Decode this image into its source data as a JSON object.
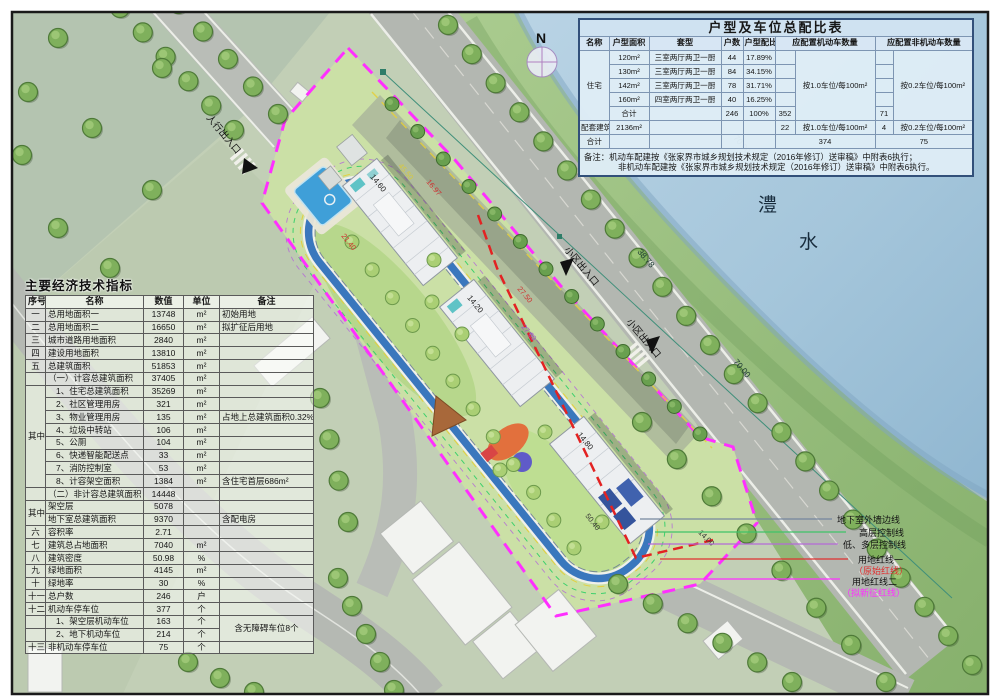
{
  "doc": {
    "north": "N",
    "river": [
      "澧",
      "水"
    ]
  },
  "labels": {
    "pedestrian_entrance": "人行出入口",
    "community_entrance": "小区出入口"
  },
  "dims": {
    "d70a": "70.00",
    "d70b": "70.00",
    "d3878": "38.78",
    "d4550": "45.50",
    "d1697": "16.97",
    "d2140": "21.40",
    "d2750": "27.50",
    "d2769": "27.69",
    "d5040": "50.40",
    "d1400": "14.00"
  },
  "elevations": [
    "14.60",
    "14.20",
    "14.80"
  ],
  "legend": {
    "items": [
      {
        "label": "地下室外墙边线",
        "color": "#76869e"
      },
      {
        "label": "高层控制线",
        "color": "#3fc468"
      },
      {
        "label": "低、多层控制线",
        "color": "#b46ad8"
      },
      {
        "label": "用地红线一",
        "sub": "（原始红线）",
        "color": "#e03030"
      },
      {
        "label": "用地红线二",
        "sub": "（拟新征红线）",
        "color": "#ff2fff"
      }
    ]
  },
  "economic_table": {
    "title": "主要经济技术指标",
    "header": [
      {
        "t": "序号",
        "cls": "h"
      },
      {
        "t": "名称",
        "cls": "h"
      },
      {
        "t": "数值",
        "cls": "h"
      },
      {
        "t": "单位",
        "cls": "h"
      },
      {
        "t": "备注",
        "cls": "h"
      }
    ],
    "rows": [
      [
        {
          "t": "一"
        },
        {
          "t": "总用地面积一",
          "cls": "L"
        },
        {
          "t": "13748"
        },
        {
          "t": "m²"
        },
        {
          "t": "初始用地",
          "cls": "L"
        }
      ],
      [
        {
          "t": "二"
        },
        {
          "t": "总用地面积二",
          "cls": "L"
        },
        {
          "t": "16650"
        },
        {
          "t": "m²"
        },
        {
          "t": "拟扩征后用地",
          "cls": "L"
        }
      ],
      [
        {
          "t": "三"
        },
        {
          "t": "城市道路用地面积",
          "cls": "L"
        },
        {
          "t": "2840"
        },
        {
          "t": "m²"
        },
        {
          "t": ""
        }
      ],
      [
        {
          "t": "四"
        },
        {
          "t": "建设用地面积",
          "cls": "L"
        },
        {
          "t": "13810"
        },
        {
          "t": "m²"
        },
        {
          "t": ""
        }
      ],
      [
        {
          "t": "五"
        },
        {
          "t": "总建筑面积",
          "cls": "L"
        },
        {
          "t": "51853"
        },
        {
          "t": "m²"
        },
        {
          "t": ""
        }
      ],
      [
        {
          "t": ""
        },
        {
          "t": "（一）计容总建筑面积",
          "cls": "L"
        },
        {
          "t": "37405"
        },
        {
          "t": "m²"
        },
        {
          "t": ""
        }
      ],
      [
        {
          "t": "其中",
          "rs": 8
        },
        {
          "t": "1、住宅总建筑面积",
          "cls": "L i"
        },
        {
          "t": "35269"
        },
        {
          "t": "m²"
        },
        {
          "t": ""
        }
      ],
      [
        {
          "t": "2、社区管理用房",
          "cls": "L i"
        },
        {
          "t": "321"
        },
        {
          "t": "m²"
        },
        {
          "t": ""
        }
      ],
      [
        {
          "t": "3、物业管理用房",
          "cls": "L i"
        },
        {
          "t": "135"
        },
        {
          "t": "m²"
        },
        {
          "t": "占地上总建筑面积0.32%",
          "cls": "L"
        }
      ],
      [
        {
          "t": "4、垃圾中转站",
          "cls": "L i"
        },
        {
          "t": "106"
        },
        {
          "t": "m²"
        },
        {
          "t": ""
        }
      ],
      [
        {
          "t": "5、公厕",
          "cls": "L i"
        },
        {
          "t": "104"
        },
        {
          "t": "m²"
        },
        {
          "t": ""
        }
      ],
      [
        {
          "t": "6、快递智能配送点",
          "cls": "L i"
        },
        {
          "t": "33"
        },
        {
          "t": "m²"
        },
        {
          "t": ""
        }
      ],
      [
        {
          "t": "7、消防控制室",
          "cls": "L i"
        },
        {
          "t": "53"
        },
        {
          "t": "m²"
        },
        {
          "t": ""
        }
      ],
      [
        {
          "t": "8、计容架空面积",
          "cls": "L i"
        },
        {
          "t": "1384"
        },
        {
          "t": "m²"
        },
        {
          "t": "含住宅首层686m²",
          "cls": "L"
        }
      ],
      [
        {
          "t": ""
        },
        {
          "t": "（二）非计容总建筑面积",
          "cls": "L"
        },
        {
          "t": "14448"
        },
        {
          "t": ""
        },
        {
          "t": ""
        }
      ],
      [
        {
          "t": "其中",
          "rs": 2
        },
        {
          "t": "架空层",
          "cls": "L"
        },
        {
          "t": "5078"
        },
        {
          "t": ""
        },
        {
          "t": ""
        }
      ],
      [
        {
          "t": "地下室总建筑面积",
          "cls": "L"
        },
        {
          "t": "9370"
        },
        {
          "t": ""
        },
        {
          "t": "含配电房",
          "cls": "L"
        }
      ],
      [
        {
          "t": "六"
        },
        {
          "t": "容积率",
          "cls": "L"
        },
        {
          "t": "2.71"
        },
        {
          "t": ""
        },
        {
          "t": ""
        }
      ],
      [
        {
          "t": "七"
        },
        {
          "t": "建筑总占地面积",
          "cls": "L"
        },
        {
          "t": "7040"
        },
        {
          "t": "m²"
        },
        {
          "t": ""
        }
      ],
      [
        {
          "t": "八"
        },
        {
          "t": "建筑密度",
          "cls": "L"
        },
        {
          "t": "50.98"
        },
        {
          "t": "%"
        },
        {
          "t": ""
        }
      ],
      [
        {
          "t": "九"
        },
        {
          "t": "绿地面积",
          "cls": "L"
        },
        {
          "t": "4145"
        },
        {
          "t": "m²"
        },
        {
          "t": ""
        }
      ],
      [
        {
          "t": "十"
        },
        {
          "t": "绿地率",
          "cls": "L"
        },
        {
          "t": "30"
        },
        {
          "t": "%"
        },
        {
          "t": ""
        }
      ],
      [
        {
          "t": "十一"
        },
        {
          "t": "总户数",
          "cls": "L"
        },
        {
          "t": "246"
        },
        {
          "t": "户"
        },
        {
          "t": ""
        }
      ],
      [
        {
          "t": "十二"
        },
        {
          "t": "机动车停车位",
          "cls": "L"
        },
        {
          "t": "377"
        },
        {
          "t": "个"
        },
        {
          "t": ""
        }
      ],
      [
        {
          "t": ""
        },
        {
          "t": "1、架空层机动车位",
          "cls": "L i"
        },
        {
          "t": "163"
        },
        {
          "t": "个"
        },
        {
          "t": "含无障碍车位8个",
          "rs": 2
        }
      ],
      [
        {
          "t": ""
        },
        {
          "t": "2、地下机动车位",
          "cls": "L i"
        },
        {
          "t": "214"
        },
        {
          "t": "个"
        }
      ],
      [
        {
          "t": "十三"
        },
        {
          "t": "非机动车停车位",
          "cls": "L"
        },
        {
          "t": "75"
        },
        {
          "t": "个"
        },
        {
          "t": ""
        }
      ]
    ]
  },
  "parking_table": {
    "title": "户型及车位总配比表",
    "header": [
      {
        "t": "名称",
        "cls": "h"
      },
      {
        "t": "户型面积",
        "cls": "h"
      },
      {
        "t": "套型",
        "cls": "h"
      },
      {
        "t": "户数",
        "cls": "h"
      },
      {
        "t": "户型配比",
        "cls": "h"
      },
      {
        "t": "应配置机动车数量",
        "cs": 2,
        "cls": "h"
      },
      {
        "t": "应配置非机动车数量",
        "cs": 2,
        "cls": "h"
      }
    ],
    "rows": [
      [
        {
          "t": "住宅",
          "rs": 5
        },
        {
          "t": "120m²"
        },
        {
          "t": "三室两厅两卫一厨"
        },
        {
          "t": "44"
        },
        {
          "t": "17.89%"
        },
        {
          "t": ""
        },
        {
          "t": "按1.0车位/每100m²",
          "rs": 5
        },
        {
          "t": ""
        },
        {
          "t": "按0.2车位/每100m²",
          "rs": 5
        }
      ],
      [
        {
          "t": "130m²"
        },
        {
          "t": "三室两厅两卫一厨"
        },
        {
          "t": "84"
        },
        {
          "t": "34.15%"
        },
        {
          "t": ""
        },
        {
          "t": ""
        }
      ],
      [
        {
          "t": "142m²"
        },
        {
          "t": "三室两厅两卫一厨"
        },
        {
          "t": "78"
        },
        {
          "t": "31.71%"
        },
        {
          "t": ""
        },
        {
          "t": ""
        }
      ],
      [
        {
          "t": "160m²"
        },
        {
          "t": "四室两厅两卫一厨"
        },
        {
          "t": "40"
        },
        {
          "t": "16.25%"
        },
        {
          "t": ""
        },
        {
          "t": ""
        }
      ],
      [
        {
          "t": "合计"
        },
        {
          "t": ""
        },
        {
          "t": "246"
        },
        {
          "t": "100%"
        },
        {
          "t": "352"
        },
        {
          "t": "71"
        }
      ],
      [
        {
          "t": "配套建筑"
        },
        {
          "t": "2136m²"
        },
        {
          "t": ""
        },
        {
          "t": ""
        },
        {
          "t": ""
        },
        {
          "t": "22"
        },
        {
          "t": "按1.0车位/每100m²"
        },
        {
          "t": "4"
        },
        {
          "t": "按0.2车位/每100m²"
        }
      ],
      [
        {
          "t": "合计"
        },
        {
          "t": ""
        },
        {
          "t": ""
        },
        {
          "t": ""
        },
        {
          "t": ""
        },
        {
          "t": "374",
          "cs": 2
        },
        {
          "t": "75",
          "cs": 2
        }
      ]
    ],
    "notes": [
      "备注：机动车配建按《张家界市城乡规划技术规定（2016年修订）送审稿》中附表6执行；",
      "非机动车配建按《张家界市城乡规划技术规定（2016年修订）送审稿》中附表6执行。"
    ]
  }
}
